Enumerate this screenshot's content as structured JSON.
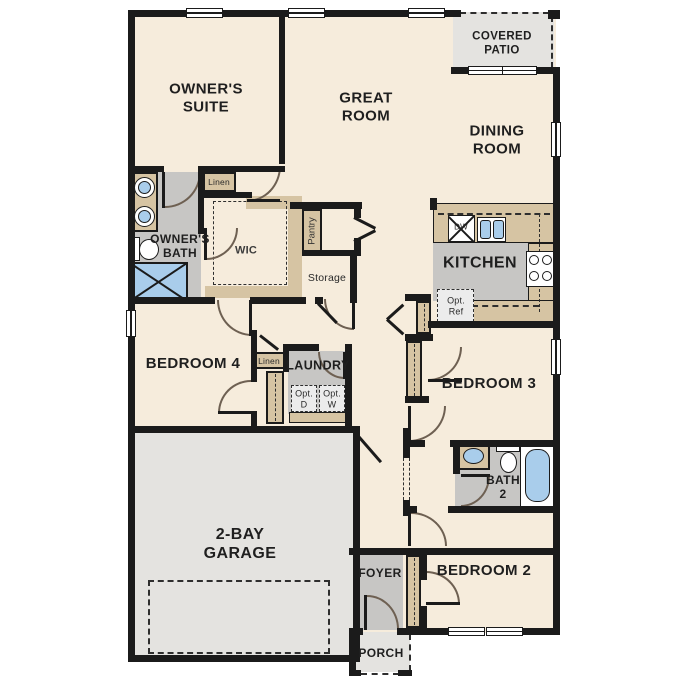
{
  "plan_title": "Single-story 4-bedroom floor plan",
  "colors": {
    "wall": "#1b1b1b",
    "floor_cream": "#f6ecdc",
    "counter_tan": "#d6c4a3",
    "floor_gray": "#c7c6c4",
    "floor_light_gray": "#e4e3e0",
    "fixture_blue": "#a9cdeb",
    "door_arc": "#6e6052"
  },
  "labels": {
    "owners_suite": "OWNER'S\nSUITE",
    "great_room": "GREAT\nROOM",
    "dining_room": "DINING\nROOM",
    "covered_patio": "COVERED\nPATIO",
    "owners_bath": "OWNER'S\nBATH",
    "wic": "WIC",
    "linen_upper": "Linen",
    "linen_hall": "Linen",
    "pantry": "Pantry",
    "storage": "Storage",
    "kitchen": "KITCHEN",
    "dw": "DW",
    "opt_ref": "Opt.\nRef",
    "bedroom4": "BEDROOM 4",
    "laundry": "LAUNDRY",
    "opt_d": "Opt.\nD",
    "opt_w": "Opt.\nW",
    "bedroom3": "BEDROOM 3",
    "bath2": "BATH\n2",
    "bedroom2": "BEDROOM 2",
    "garage": "2-BAY\nGARAGE",
    "foyer": "FOYER",
    "porch": "PORCH"
  }
}
